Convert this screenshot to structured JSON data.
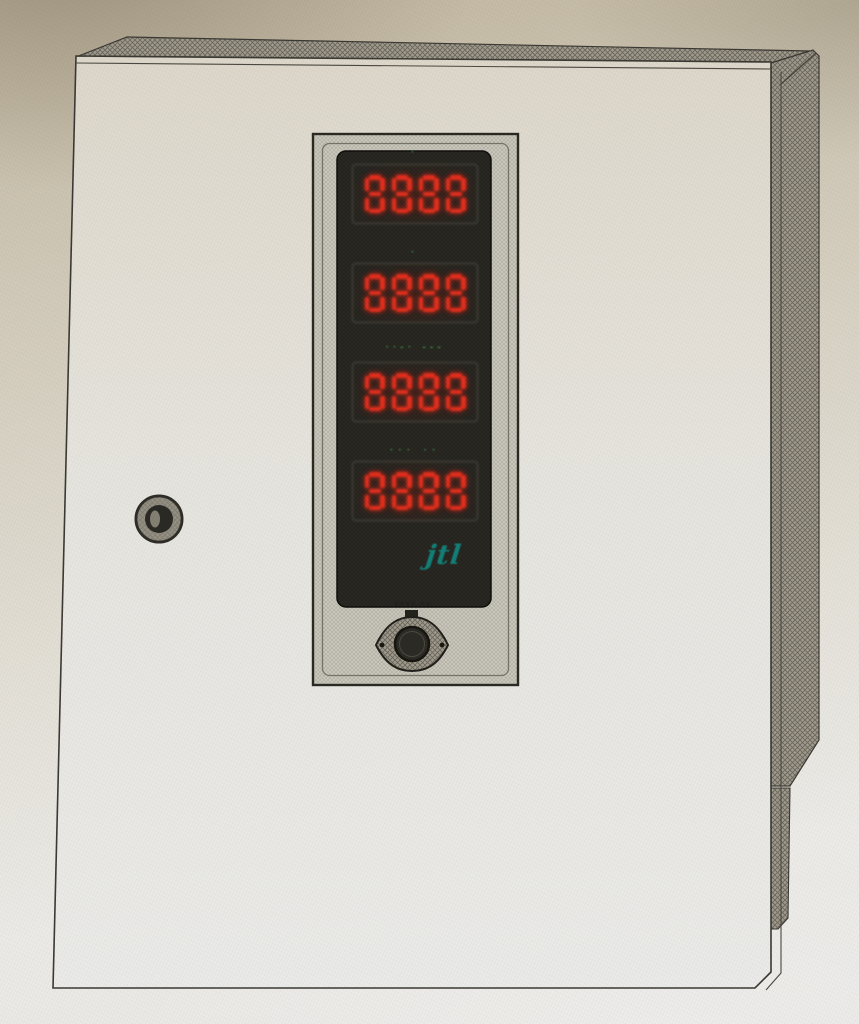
{
  "device": {
    "logo_text": "jtl",
    "displays": [
      {
        "digits": "8888",
        "indicator_marks": "·"
      },
      {
        "digits": "8888",
        "indicator_marks": "·"
      },
      {
        "digits": "8888",
        "indicator_marks": "··-· ---"
      },
      {
        "digits": "8888",
        "indicator_marks": "··· ··"
      }
    ],
    "knob_caption_marks": "▪▪▪▪ ▪▪"
  },
  "colors": {
    "paper_top": "#c1b6a0",
    "paper_bottom": "#e9e8e6",
    "cabinet_face": "#e0dacd",
    "outline": "#3b3933",
    "hatch_side": "#8f8a7d",
    "panel_bezel": "#cac7bc",
    "display_window": "#24231e",
    "led_red": "#d93222",
    "indicator_green": "#45a24f",
    "logo_teal": "#128078"
  }
}
